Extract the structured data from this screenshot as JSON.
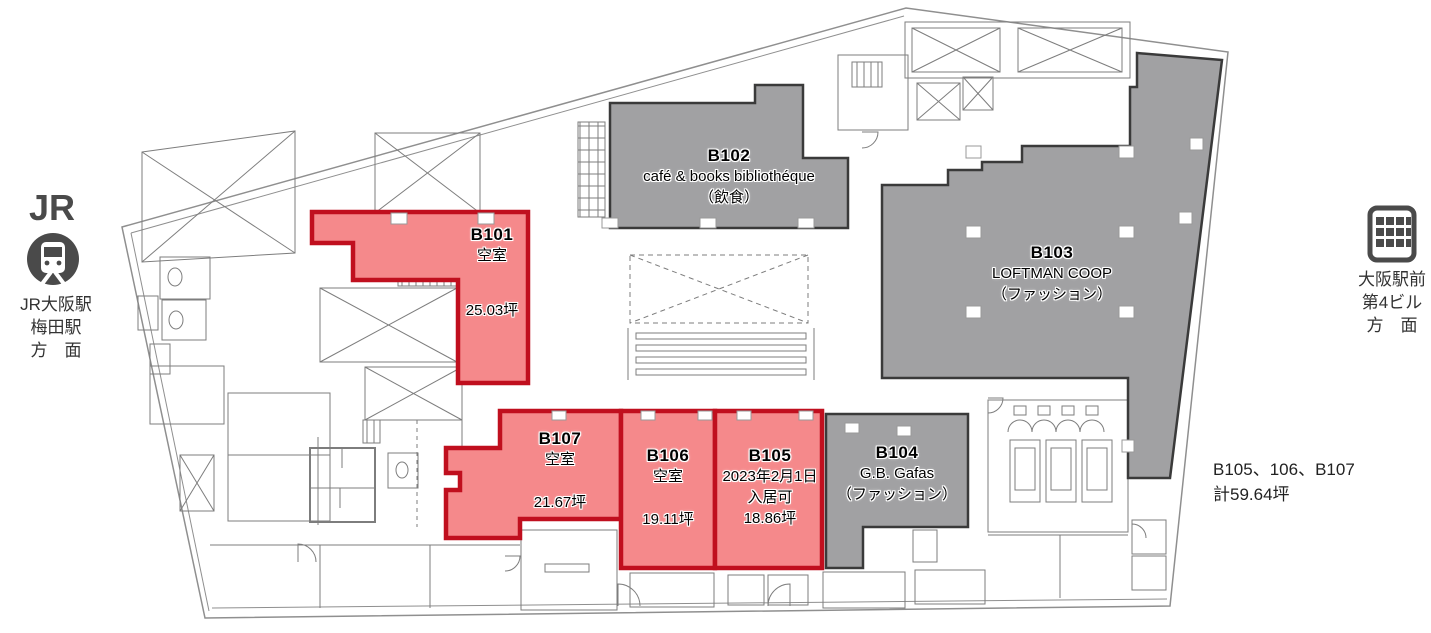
{
  "colors": {
    "vacant_fill": "#f5898b",
    "vacant_border": "#c00f1e",
    "occupied_fill": "#a1a1a3",
    "occupied_border": "#3a3a3a",
    "plan_line": "#7d7d7d",
    "icon_gray": "#4a4a4a"
  },
  "left_station": {
    "logo_text": "JR",
    "icons": [
      "jr-logo",
      "train-icon"
    ],
    "lines": [
      "JR大阪駅",
      "梅田駅",
      "方　面"
    ]
  },
  "right_landmark": {
    "icons": [
      "building-icon"
    ],
    "lines": [
      "大阪駅前",
      "第4ビル",
      "方　面"
    ]
  },
  "units": [
    {
      "id": "B101",
      "status": "vacant",
      "status_text": "空室",
      "area_text": "25.03坪"
    },
    {
      "id": "B102",
      "status": "occupied",
      "tenant": "café & books bibliothéque",
      "category": "（飲食）"
    },
    {
      "id": "B103",
      "status": "occupied",
      "tenant": "LOFTMAN COOP",
      "category": "（ファッション）"
    },
    {
      "id": "B104",
      "status": "occupied",
      "tenant": "G.B. Gafas",
      "category": "（ファッション）"
    },
    {
      "id": "B105",
      "status": "vacant",
      "move_in_line1": "2023年2月1日",
      "move_in_line2": "入居可",
      "area_text": "18.86坪"
    },
    {
      "id": "B106",
      "status": "vacant",
      "status_text": "空室",
      "area_text": "19.11坪"
    },
    {
      "id": "B107",
      "status": "vacant",
      "status_text": "空室",
      "area_text": "21.67坪"
    }
  ],
  "note": {
    "line1": "B105、106、B107",
    "line2": "計59.64坪"
  }
}
